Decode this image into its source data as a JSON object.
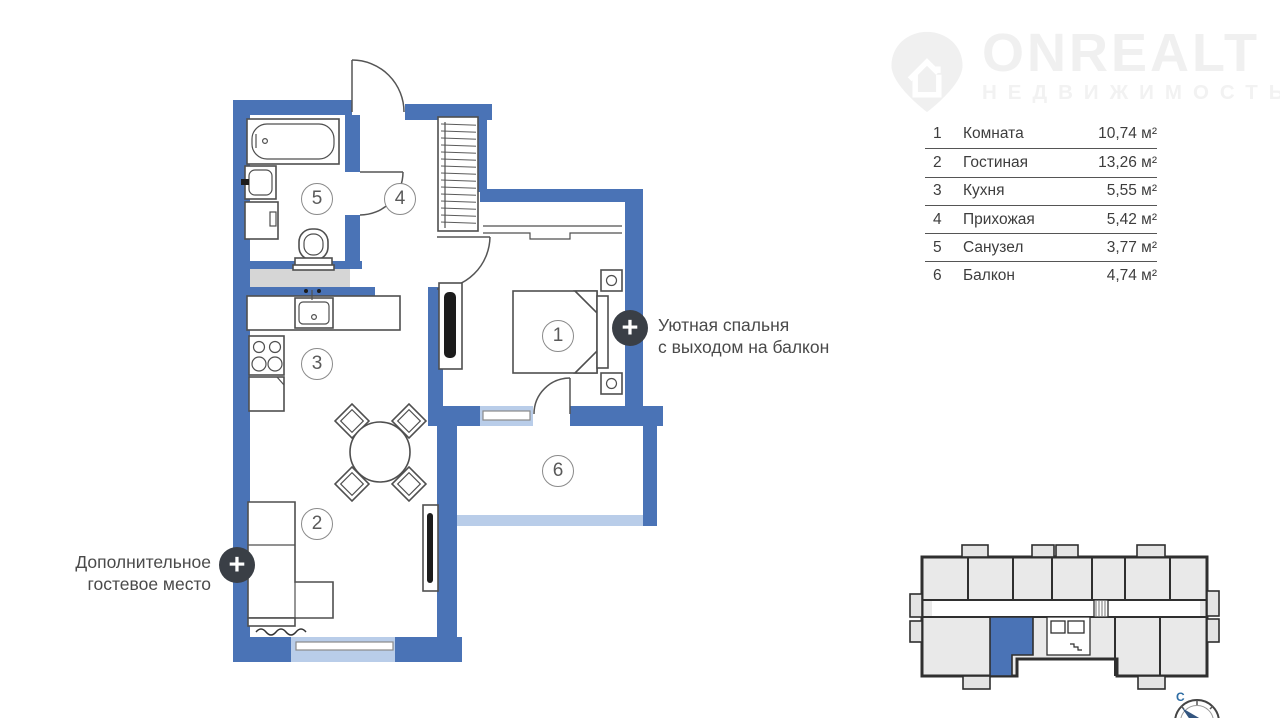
{
  "logo": {
    "title": "ONREALT",
    "subtitle": "НЕДВИЖИМОСТЬ"
  },
  "legend": {
    "rows": [
      {
        "num": "1",
        "name": "Комната",
        "area": "10,74 м²"
      },
      {
        "num": "2",
        "name": "Гостиная",
        "area": "13,26 м²"
      },
      {
        "num": "3",
        "name": "Кухня",
        "area": "5,55 м²"
      },
      {
        "num": "4",
        "name": "Прихожая",
        "area": "5,42 м²"
      },
      {
        "num": "5",
        "name": "Санузел",
        "area": "3,77 м²"
      },
      {
        "num": "6",
        "name": "Балкон",
        "area": "4,74 м²"
      }
    ]
  },
  "plan": {
    "rooms": [
      {
        "number": "1"
      },
      {
        "number": "2"
      },
      {
        "number": "3"
      },
      {
        "number": "4"
      },
      {
        "number": "5"
      },
      {
        "number": "6"
      }
    ],
    "annotations": [
      {
        "line1": "Уютная спальня",
        "line2": "с выходом на балкон"
      },
      {
        "line1": "Дополнительное",
        "line2": "гостевое место"
      }
    ]
  },
  "icons": {
    "plus": "+"
  },
  "minimap": {
    "compass_label": "С"
  },
  "colors": {
    "wall": "#4a73b6",
    "window": "#b9cde9",
    "shaft": "#d6d6d6",
    "highlight": "#4a73b6",
    "plus-badge": "#3a3f46"
  }
}
